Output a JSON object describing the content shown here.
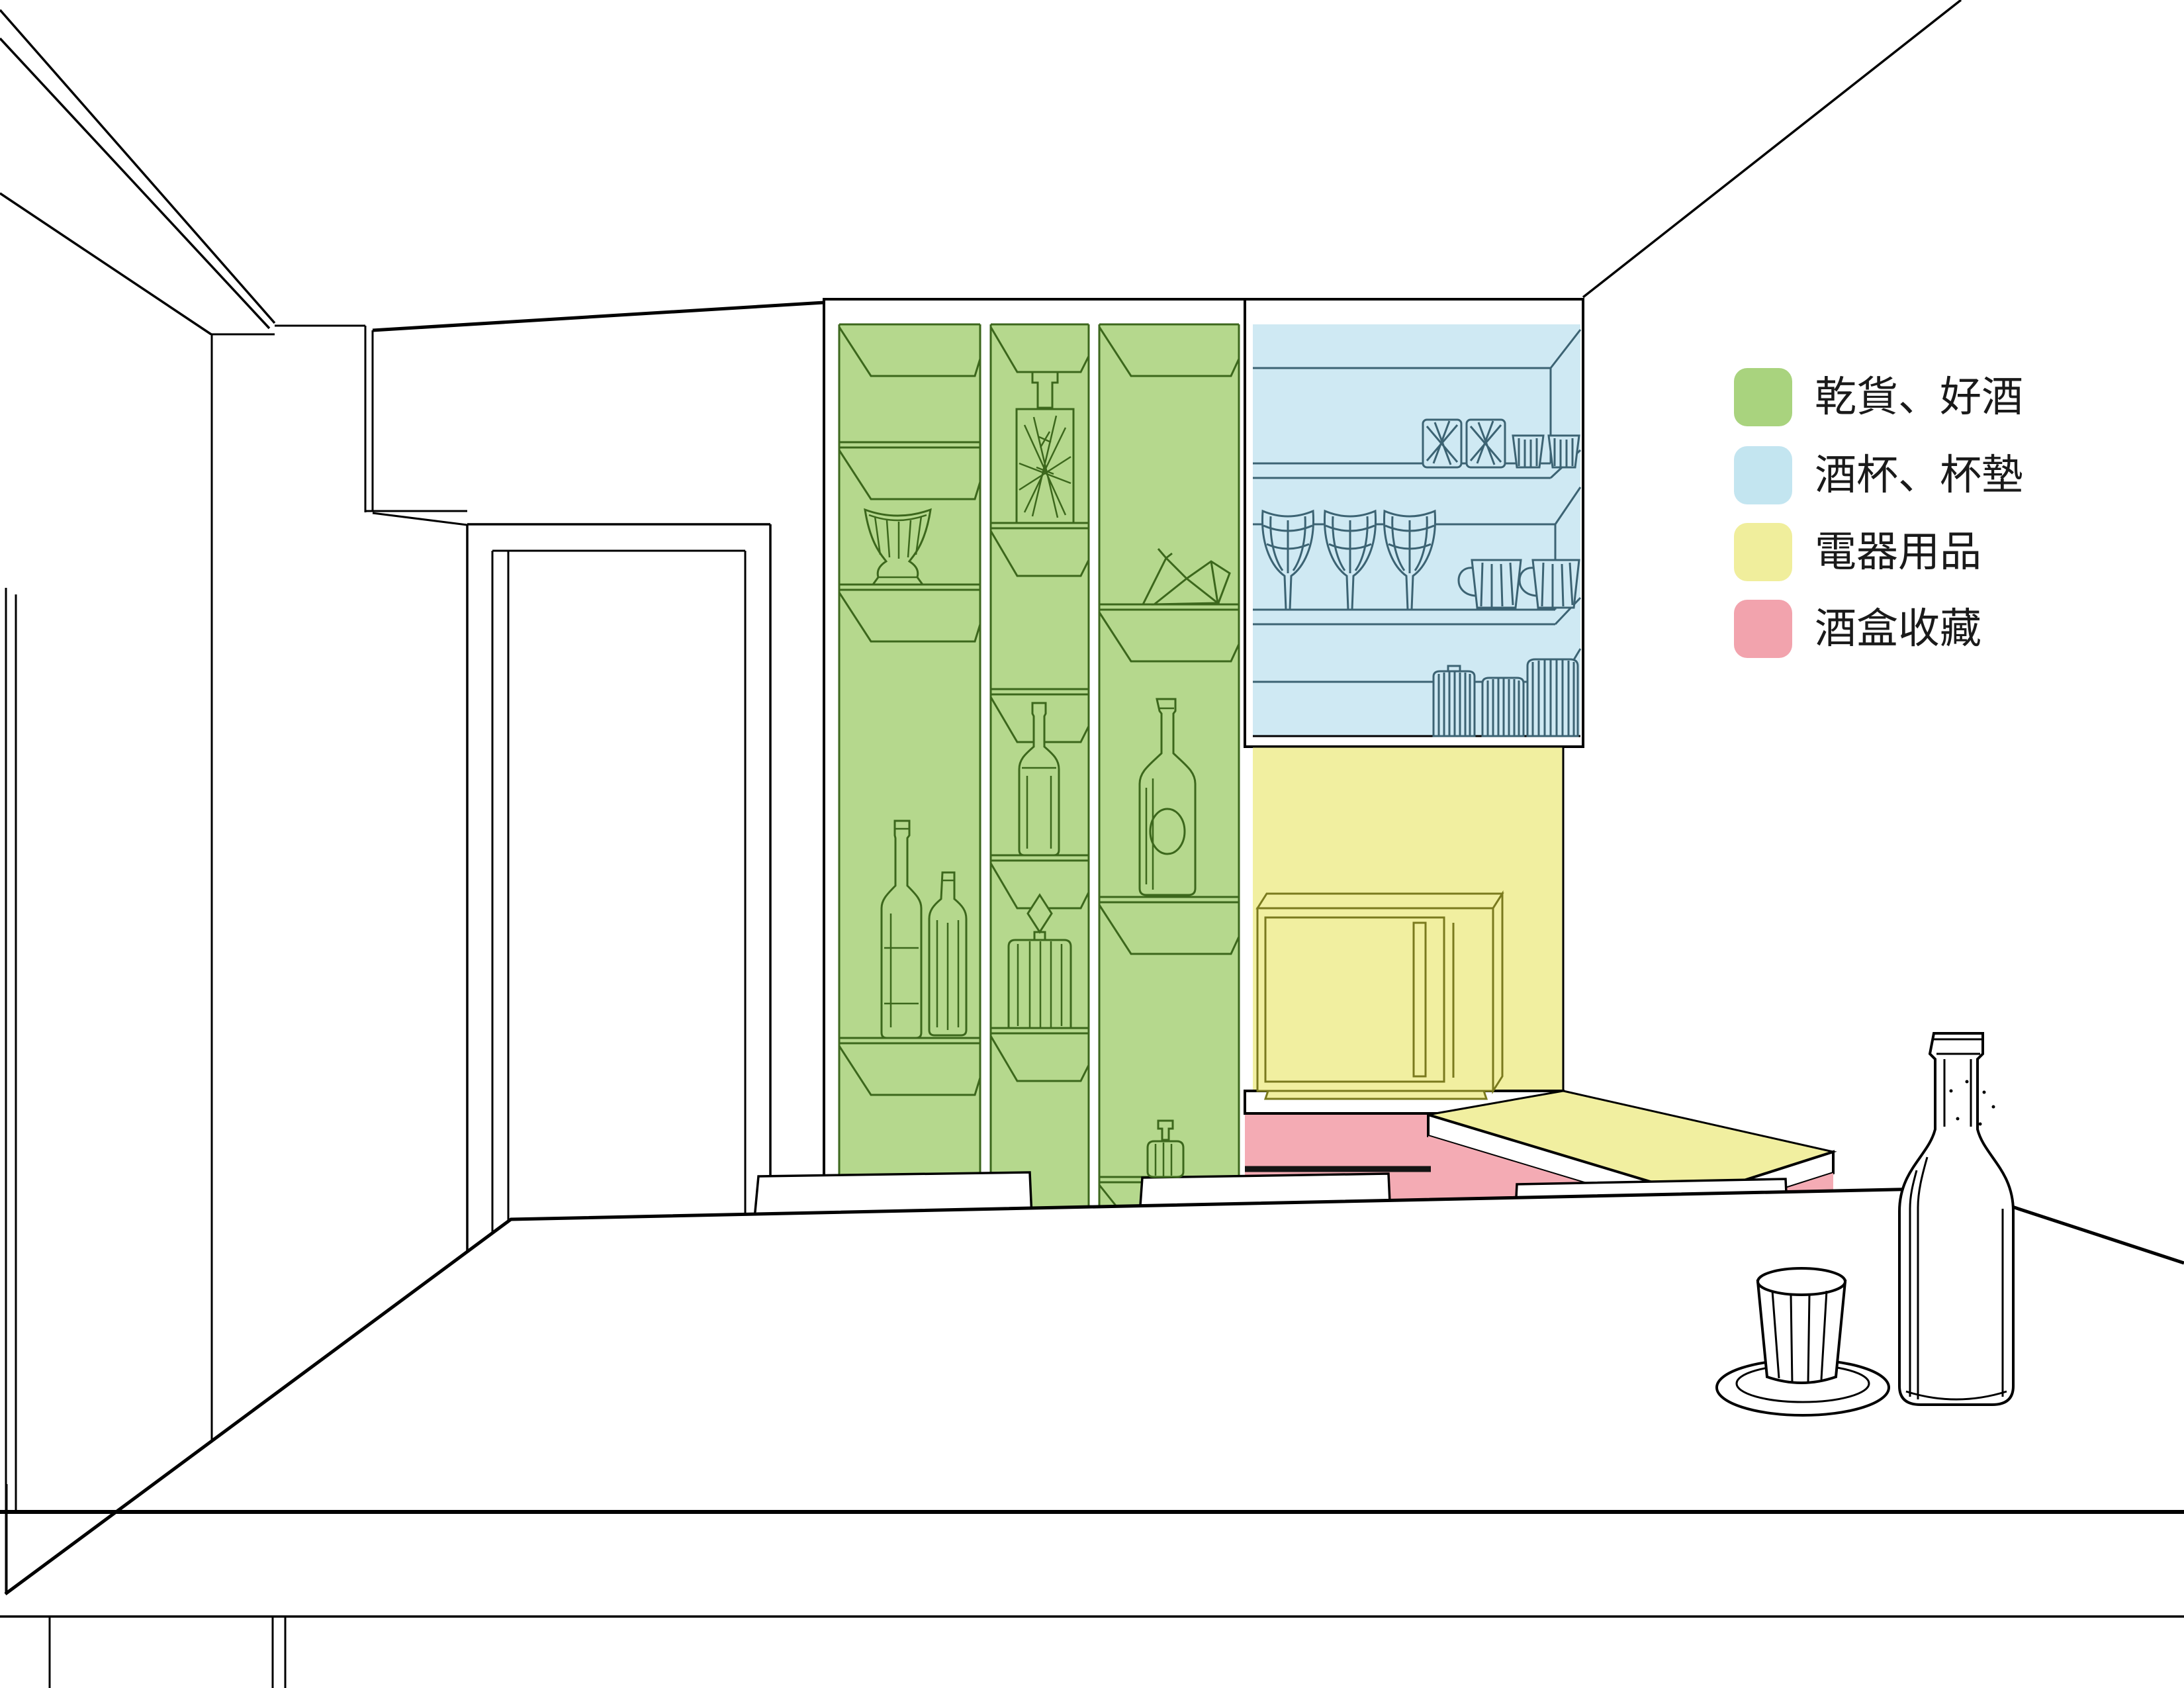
{
  "legend": {
    "items": [
      {
        "id": "dry-goods-wine",
        "label": "乾貨、好酒",
        "color": "#a9d37e"
      },
      {
        "id": "glasses-coasters",
        "label": "酒杯、杯墊",
        "color": "#c3e5f0"
      },
      {
        "id": "appliances",
        "label": "電器用品",
        "color": "#f0ee9c"
      },
      {
        "id": "wine-box-collection",
        "label": "酒盒收藏",
        "color": "#f2a3ad"
      }
    ]
  },
  "zones": {
    "dry_goods": {
      "name": "乾貨、好酒",
      "fill": "#b5d88d",
      "line": "#3c671c"
    },
    "glassware": {
      "name": "酒杯、杯墊",
      "fill": "#cfe9f3",
      "line": "#3c6373"
    },
    "appliances": {
      "name": "電器用品",
      "fill": "#f1efa0",
      "line": "#7a7a1e"
    },
    "wine_boxes": {
      "name": "酒盒收藏",
      "fill": "#f4abb4",
      "line": "#141414"
    }
  },
  "objects": {
    "green_shelf_items": [
      "vase",
      "bamboo-decanter",
      "sake-bottle",
      "faceted-decanter",
      "origami-crane",
      "wine-bottle",
      "short-bottle",
      "small-decanter"
    ],
    "blue_cabinet_items": [
      "cut-tumblers",
      "small-cups",
      "wine-glasses",
      "mugs",
      "striped-canisters"
    ],
    "appliance_items": [
      "microwave-oven"
    ],
    "foreground_items": [
      "wine-bottle",
      "faceted-cup-on-saucer"
    ],
    "furniture": [
      "dining-table",
      "chair-backs",
      "door"
    ]
  }
}
